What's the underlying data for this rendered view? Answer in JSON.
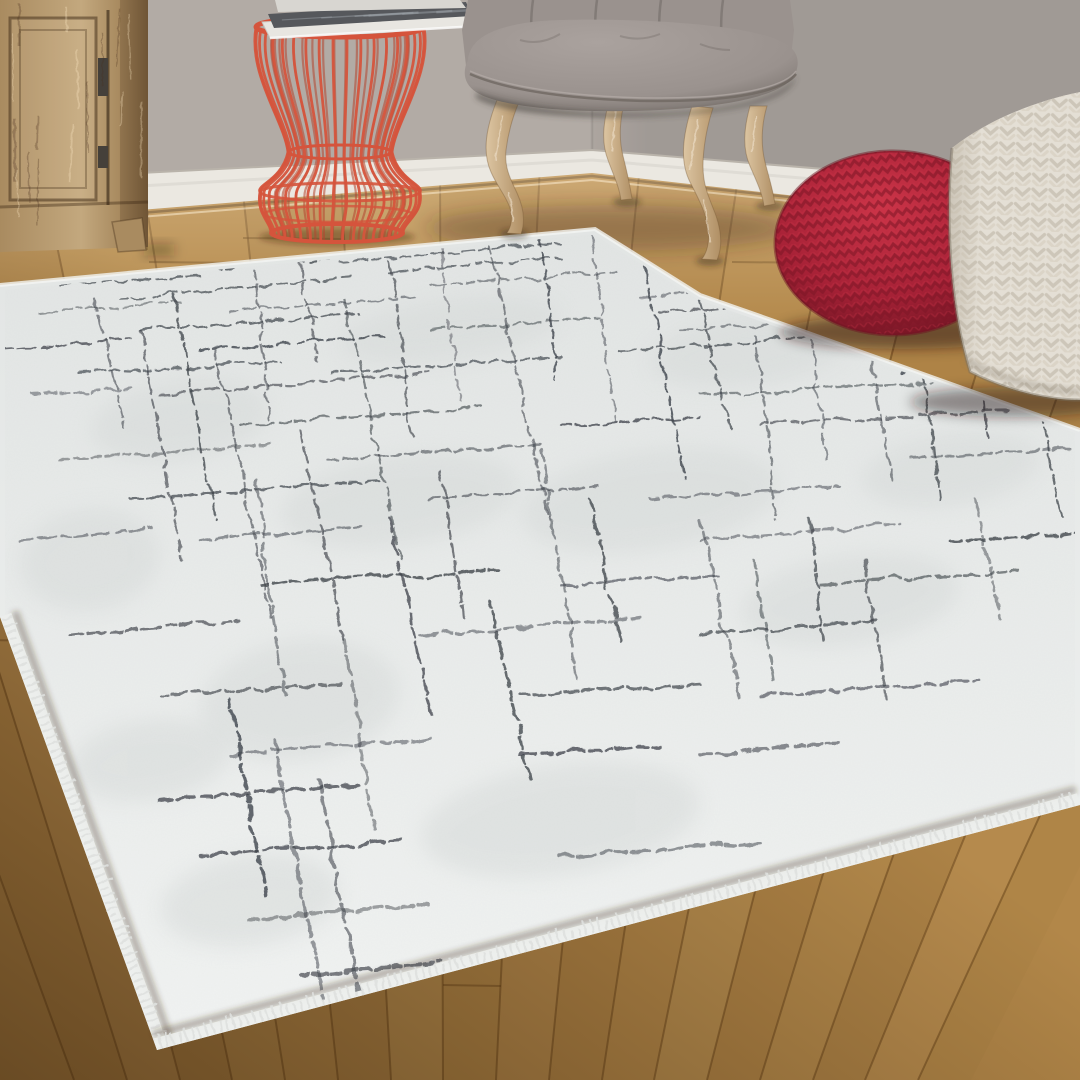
{
  "scene": {
    "type": "interior-product-photo",
    "subject": "white abstract grid area rug in living room",
    "canvas": {
      "width": 1080,
      "height": 1080
    }
  },
  "palette": {
    "wall_left": "#b2aba5",
    "wall_right": "#a69f9a",
    "baseboard": "#ebe8e1",
    "baseboard_shadow": "#b9b3aa",
    "floor_base": "#b28749",
    "floor_seam": "#5c3a14",
    "floor_sheen": "#ffe9c4",
    "floor_dark": "#2e1a06",
    "cabinet_light": "#c3a87e",
    "cabinet_mid": "#a98b60",
    "cabinet_dark": "#7a5f3d",
    "hinge": "#45403a",
    "table_red": "#d5543c",
    "table_red_dark": "#b24530",
    "mag_pages": "#e8e6e1",
    "mag_cover": "#56585c",
    "mag_cover_hi": "#9aa0a6",
    "chair_fabric": "#9a928e",
    "chair_fabric_light": "#aaa29e",
    "chair_fabric_dark": "#766f6a",
    "piping": "#6f6862",
    "leg_light": "#dcc5a2",
    "leg_mid": "#b08f64",
    "pouf_red_hi": "#cc3448",
    "pouf_red": "#a62136",
    "pouf_red_dark": "#701523",
    "knit_red_line": "#7d1626",
    "pouf_white": "#e4dfd5",
    "pouf_white_dark": "#b9b0a0",
    "knit_white_line": "#c9c2b4",
    "rug_far": "#e2e5e4",
    "rug_near": "#f1f3f2",
    "rug_mottle": "#d5d9d8",
    "rug_line": "#3d4249",
    "selvedge": "#f4f5f3",
    "fringe": "#eceeec"
  },
  "wall": {
    "corner_x": 592,
    "height": 240
  },
  "baseboard": {
    "left": [
      [
        140,
        173
      ],
      [
        592,
        150
      ],
      [
        592,
        173
      ],
      [
        140,
        210
      ]
    ],
    "right": [
      [
        592,
        150
      ],
      [
        1080,
        190
      ],
      [
        1080,
        228
      ],
      [
        592,
        173
      ]
    ]
  },
  "floor": {
    "top_edge": [
      [
        0,
        212
      ],
      [
        140,
        210
      ],
      [
        592,
        172
      ],
      [
        1080,
        224
      ]
    ],
    "vanishing_point": [
      447,
      2051
    ],
    "seam_xs": [
      -260,
      -160,
      -60,
      40,
      140,
      240,
      340,
      440,
      540,
      640,
      740,
      840,
      940,
      1040,
      1140,
      1240,
      1340,
      1440
    ],
    "plank_shades": [
      3,
      -4,
      6,
      -2,
      0,
      5,
      -5,
      2,
      -3,
      4,
      0,
      -6,
      3,
      -2,
      5,
      -4,
      2
    ],
    "butt_joints": [
      [
        1,
        640
      ],
      [
        2,
        330
      ],
      [
        3,
        470
      ],
      [
        4,
        262
      ],
      [
        5,
        238
      ],
      [
        6,
        700
      ],
      [
        7,
        985
      ],
      [
        8,
        256
      ],
      [
        9,
        880
      ],
      [
        10,
        262
      ],
      [
        11,
        520
      ],
      [
        12,
        300
      ],
      [
        13,
        655
      ],
      [
        14,
        432
      ],
      [
        15,
        335
      ],
      [
        16,
        560
      ]
    ]
  },
  "cabinet": {
    "x0": 0,
    "x1": 148,
    "bottom": 250,
    "door": [
      10,
      18,
      86,
      182
    ],
    "gap_x": 108,
    "hinges": [
      [
        98,
        58,
        10,
        38
      ],
      [
        98,
        146,
        10,
        22
      ]
    ],
    "foot": [
      [
        112,
        222
      ],
      [
        142,
        218
      ],
      [
        146,
        250
      ],
      [
        118,
        252
      ]
    ]
  },
  "wire_table": {
    "cx": 340,
    "rim_y": 27,
    "rim_rx": 84,
    "waist_y": 152,
    "waist_rx": 52,
    "bulge_y": 192,
    "bulge_rx": 80,
    "base_cx": 337,
    "base_y": 233,
    "base_rx": 66,
    "wires": 20
  },
  "magazines": {
    "top_sliver": [
      [
        275,
        0
      ],
      [
        460,
        0
      ],
      [
        466,
        8
      ],
      [
        278,
        12
      ]
    ],
    "cover": [
      [
        268,
        14
      ],
      [
        466,
        2
      ],
      [
        472,
        16
      ],
      [
        274,
        28
      ]
    ],
    "pages": [
      [
        262,
        22
      ],
      [
        470,
        10
      ],
      [
        478,
        26
      ],
      [
        270,
        38
      ]
    ]
  },
  "chair": {
    "back": [
      [
        468,
        0
      ],
      [
        462,
        30
      ],
      [
        466,
        66
      ],
      [
        790,
        66
      ],
      [
        794,
        30
      ],
      [
        790,
        0
      ]
    ],
    "tuft_xs": [
      533,
      597,
      661,
      723
    ],
    "legs": [
      "M497,100 C486,128 482,152 491,172 C497,186 506,196 510,208 C513,219 511,227 507,233 L521,234 C526,220 523,206 517,193 C511,180 504,168 506,150 C508,134 513,116 519,102 Z",
      "M610,98 C603,122 601,142 608,160 C613,174 619,186 621,200 L632,199 C630,185 627,172 623,156 C619,140 619,122 625,100 Z",
      "M692,106 C682,138 680,162 690,182 C698,198 706,212 708,228 C710,243 707,252 702,259 L717,260 C723,246 721,229 715,213 C709,197 703,186 703,166 C703,148 707,126 713,108 Z",
      "M750,106 C744,128 742,148 750,166 C756,180 762,192 764,206 L775,204 C773,190 769,178 765,162 C761,146 761,126 767,106 Z"
    ],
    "leg_tips": [
      [
        514,
        234
      ],
      [
        627,
        202
      ],
      [
        710,
        261
      ],
      [
        770,
        206
      ]
    ]
  },
  "red_pouf": {
    "cx": 893,
    "cy": 243,
    "rx": 118,
    "ry": 92
  },
  "white_pouf": {
    "outline": "M952,148 C946,210 948,300 970,372 C1010,392 1050,400 1080,400 L1080,92 C1040,100 990,118 952,148 Z"
  },
  "rug": {
    "polygon": [
      [
        0,
        285
      ],
      [
        595,
        229
      ],
      [
        700,
        295
      ],
      [
        800,
        330
      ],
      [
        1080,
        430
      ],
      [
        1080,
        805
      ],
      [
        157,
        1050
      ],
      [
        0,
        617
      ]
    ],
    "clip": [
      [
        5,
        290
      ],
      [
        593,
        234
      ],
      [
        697,
        299
      ],
      [
        797,
        334
      ],
      [
        1075,
        433
      ],
      [
        1075,
        800
      ],
      [
        160,
        1044
      ],
      [
        5,
        622
      ]
    ],
    "fringe_edges": [
      [
        [
          0,
          617
        ],
        [
          157,
          1050
        ]
      ],
      [
        [
          157,
          1050
        ],
        [
          1080,
          805
        ]
      ]
    ],
    "selvedge_path": [
      [
        0,
        285
      ],
      [
        595,
        229
      ],
      [
        700,
        295
      ],
      [
        800,
        330
      ],
      [
        1080,
        430
      ]
    ],
    "mottles": [
      [
        180,
        420,
        90,
        40
      ],
      [
        90,
        560,
        70,
        50
      ],
      [
        400,
        500,
        120,
        45
      ],
      [
        300,
        700,
        100,
        60
      ],
      [
        650,
        500,
        130,
        50
      ],
      [
        850,
        600,
        110,
        45
      ],
      [
        560,
        820,
        140,
        55
      ],
      [
        250,
        900,
        90,
        45
      ],
      [
        750,
        350,
        100,
        35
      ],
      [
        950,
        470,
        90,
        35
      ],
      [
        450,
        330,
        110,
        30
      ],
      [
        150,
        760,
        80,
        40
      ]
    ],
    "h_lines": [
      [
        262,
        340,
        560
      ],
      [
        272,
        150,
        330
      ],
      [
        272,
        390,
        560
      ],
      [
        285,
        60,
        200
      ],
      [
        285,
        430,
        620
      ],
      [
        298,
        120,
        350
      ],
      [
        298,
        640,
        690
      ],
      [
        312,
        40,
        180
      ],
      [
        312,
        230,
        420
      ],
      [
        312,
        660,
        750
      ],
      [
        330,
        140,
        360
      ],
      [
        330,
        430,
        600
      ],
      [
        330,
        680,
        860
      ],
      [
        350,
        0,
        130
      ],
      [
        350,
        200,
        390
      ],
      [
        350,
        620,
        830
      ],
      [
        350,
        880,
        1040
      ],
      [
        372,
        80,
        280
      ],
      [
        372,
        330,
        560
      ],
      [
        372,
        900,
        1060
      ],
      [
        395,
        30,
        130
      ],
      [
        395,
        160,
        430
      ],
      [
        395,
        700,
        950
      ],
      [
        395,
        1000,
        1080
      ],
      [
        425,
        240,
        480
      ],
      [
        425,
        560,
        700
      ],
      [
        425,
        760,
        1010
      ],
      [
        458,
        60,
        270
      ],
      [
        458,
        330,
        540
      ],
      [
        458,
        910,
        1080
      ],
      [
        498,
        130,
        380
      ],
      [
        498,
        430,
        600
      ],
      [
        498,
        650,
        840
      ],
      [
        540,
        20,
        150
      ],
      [
        540,
        200,
        360
      ],
      [
        540,
        700,
        900
      ],
      [
        540,
        950,
        1080
      ],
      [
        585,
        260,
        500
      ],
      [
        585,
        560,
        720
      ],
      [
        585,
        820,
        1020
      ],
      [
        635,
        70,
        240
      ],
      [
        635,
        420,
        640
      ],
      [
        635,
        700,
        880
      ],
      [
        695,
        160,
        340
      ],
      [
        695,
        520,
        700
      ],
      [
        695,
        760,
        980
      ],
      [
        755,
        230,
        430
      ],
      [
        755,
        520,
        660
      ],
      [
        755,
        700,
        840
      ],
      [
        800,
        160,
        360
      ],
      [
        855,
        200,
        400
      ],
      [
        855,
        560,
        760
      ],
      [
        920,
        250,
        430
      ],
      [
        975,
        300,
        440
      ]
    ],
    "v_lines": [
      [
        95,
        300,
        430
      ],
      [
        140,
        330,
        560
      ],
      [
        175,
        295,
        520
      ],
      [
        215,
        350,
        620
      ],
      [
        255,
        270,
        420
      ],
      [
        255,
        480,
        700
      ],
      [
        300,
        262,
        360
      ],
      [
        300,
        430,
        640
      ],
      [
        345,
        300,
        560
      ],
      [
        345,
        640,
        830
      ],
      [
        390,
        262,
        440
      ],
      [
        390,
        520,
        720
      ],
      [
        440,
        250,
        400
      ],
      [
        440,
        470,
        620
      ],
      [
        490,
        245,
        520
      ],
      [
        490,
        600,
        780
      ],
      [
        540,
        238,
        380
      ],
      [
        540,
        450,
        680
      ],
      [
        590,
        236,
        420
      ],
      [
        590,
        500,
        640
      ],
      [
        645,
        268,
        480
      ],
      [
        700,
        300,
        430
      ],
      [
        700,
        520,
        700
      ],
      [
        755,
        335,
        520
      ],
      [
        755,
        560,
        680
      ],
      [
        810,
        340,
        460
      ],
      [
        810,
        520,
        640
      ],
      [
        865,
        345,
        480
      ],
      [
        865,
        560,
        700
      ],
      [
        920,
        355,
        500
      ],
      [
        975,
        340,
        440
      ],
      [
        975,
        500,
        620
      ],
      [
        1030,
        360,
        520
      ],
      [
        230,
        700,
        900
      ],
      [
        275,
        740,
        1000
      ],
      [
        320,
        780,
        1030
      ]
    ]
  }
}
